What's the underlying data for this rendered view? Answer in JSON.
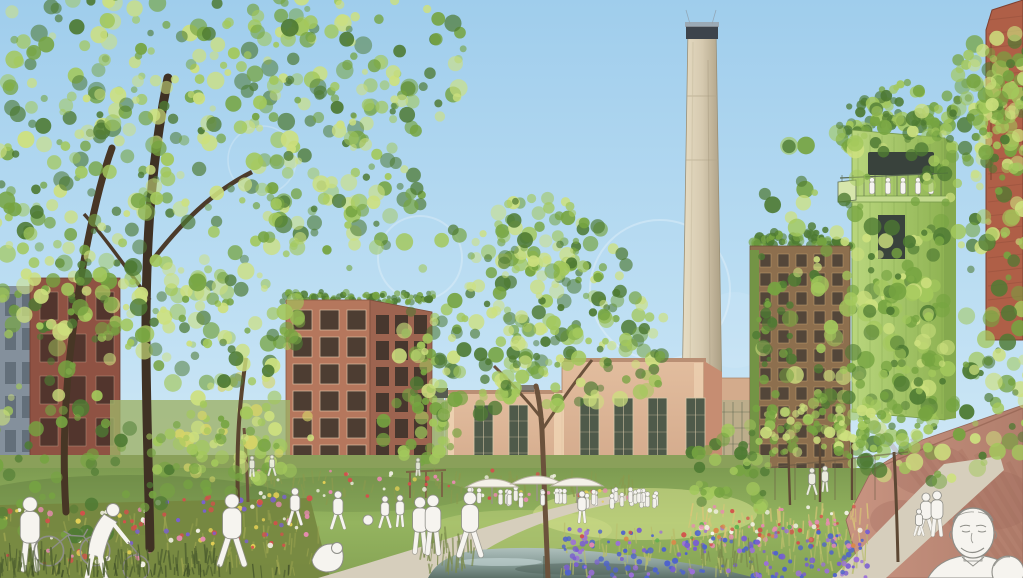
{
  "scene": {
    "type": "architectural-rendering",
    "description": "Watercolor-style masterplan visualization: park with pond and wildflower meadows in front of a converted power-plant hall with tall chimney, green repurposed industrial tower, timber high-rise and brick housing, sketched white figures",
    "cafe_sign": "PARKCAFE"
  },
  "palette": {
    "sky_top": "#9fcdec",
    "sky_mid": "#bedff3",
    "sky_bottom": "#dceef8",
    "cloud": "#ffffff",
    "chimney_light": "#e7ddc4",
    "chimney_mid": "#d6cab0",
    "chimney_dark": "#ab9e83",
    "chimney_cap": "#3d444c",
    "hall_light": "#e2bd9e",
    "hall_dark": "#cfa486",
    "hall_pilaster": "#eed3b3",
    "hall_window": "#4f5a4a",
    "hall_sign_text": "#4b443d",
    "brick_left_gray": "#84909c",
    "brick_left": "#8f5243",
    "apartment_front": "#b5775d",
    "apartment_side": "#9d6450",
    "apartment_window": "#45392f",
    "highrise_wall": "#8d6f4e",
    "highrise_window": "#4a4036",
    "tower_green_light": "#b9d67d",
    "tower_green_dark": "#8fb353",
    "tower_window": "#39423c",
    "brick_right": "#af5f47",
    "wall_light": "#c89481",
    "wall_dark": "#b17e6c",
    "path": "#d6cebc",
    "lawn_top": "#7d9b51",
    "lawn_mid": "#94b45f",
    "lawn_sun": "#dde593",
    "meadow_olive": "#76863f",
    "pond_top": "#aebfbc",
    "pond_mid": "#8ba09b",
    "pond_dark": "#5d7169",
    "trunk_dark": "#473625",
    "trunk_mid": "#6b523c",
    "leaf_dark": "#4e7a33",
    "leaf_mid": "#76a441",
    "leaf_light": "#a3c85c",
    "leaf_sun": "#cde07e",
    "leaf_yellow": "#d6d468",
    "figure_fill": "#f6f4ef",
    "figure_stroke": "#8e8e88",
    "flower_red": "#d2504b",
    "flower_pink": "#e68bb0",
    "flower_yellow": "#e3cf55",
    "flower_white": "#f4f2e8",
    "flower_orange": "#d9894a",
    "flower_blue": "#4f63cc",
    "flower_purple": "#7a5fd0",
    "flower_violet": "#9b6fd9"
  }
}
